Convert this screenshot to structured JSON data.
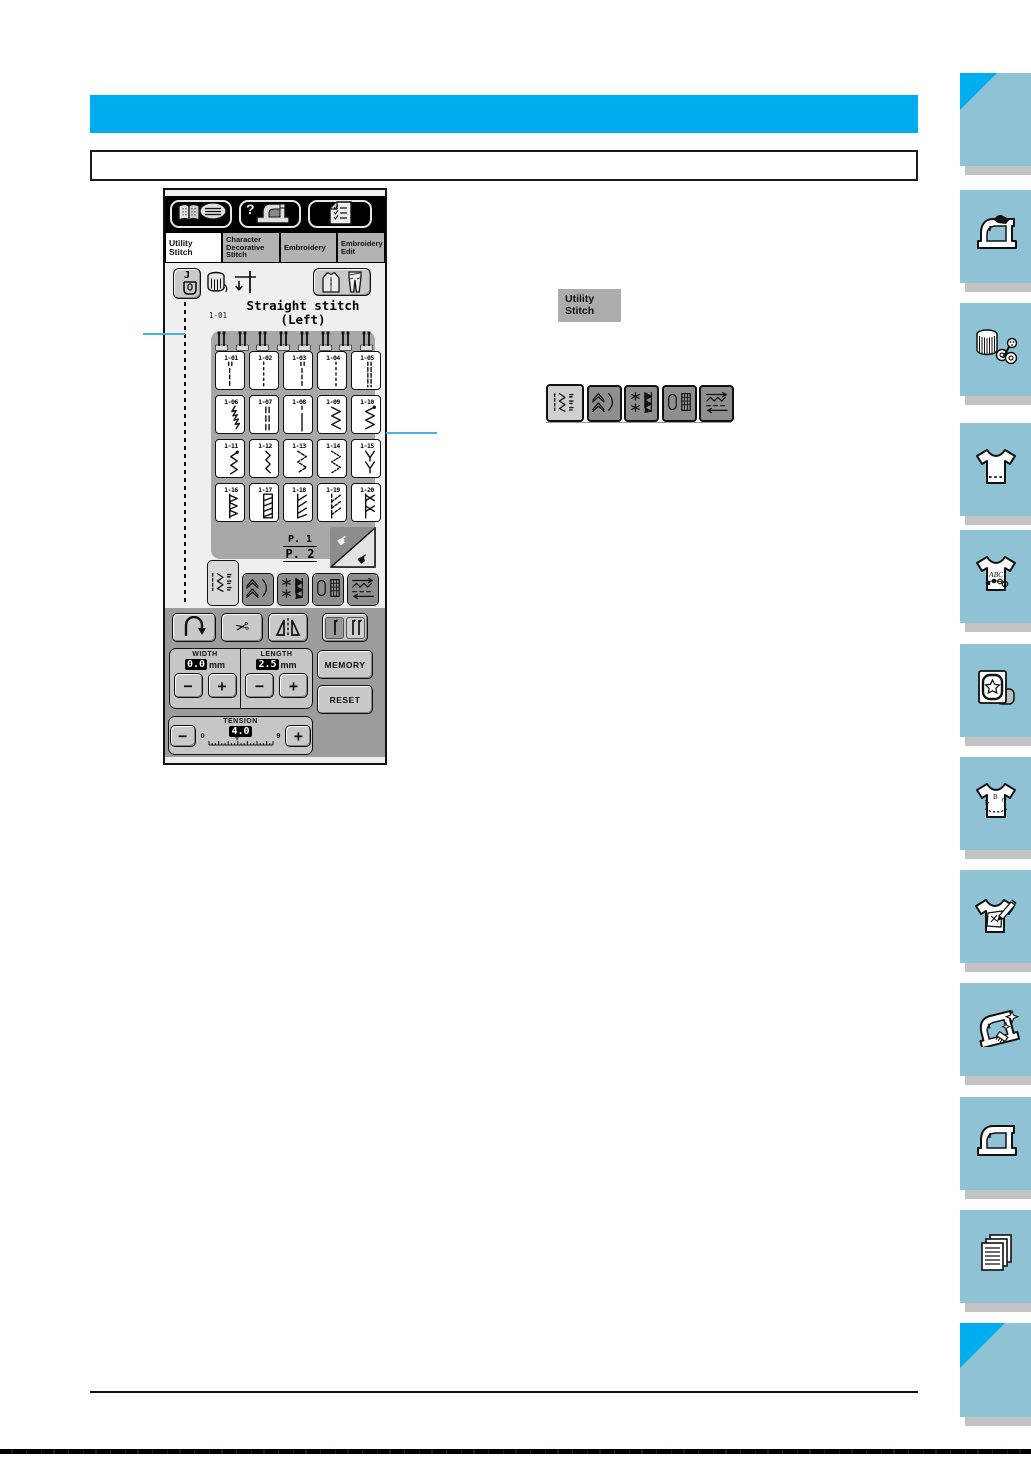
{
  "page": {
    "header_bar_text": "",
    "subheading_box_text": ""
  },
  "colors": {
    "accent_cyan": "#00AEEF",
    "callout_cyan": "#45B2E2",
    "sidebar_blue": "#8FC2D5",
    "sidebar_shadow_grey": "#C3C3C3",
    "lcd_panel_grey": "#A8A8A8",
    "lcd_control_grey": "#9C9C9C"
  },
  "lcd": {
    "top_buttons": [
      {
        "name": "operation-guide-button",
        "icon": "book-guide-icon"
      },
      {
        "name": "troubleshooting-button",
        "icon": "question-machine-icon"
      },
      {
        "name": "settings-button",
        "icon": "checklist-icon"
      }
    ],
    "tabs": [
      {
        "name": "tab-utility-stitch",
        "lines": [
          "Utility",
          "Stitch"
        ],
        "active": true
      },
      {
        "name": "tab-character-decorative-stitch",
        "lines": [
          "Character",
          "Decorative",
          "Stitch"
        ],
        "active": false
      },
      {
        "name": "tab-embroidery",
        "lines": [
          "Embroidery"
        ],
        "active": false
      },
      {
        "name": "tab-embroidery-edit",
        "lines": [
          "Embroidery",
          "Edit"
        ],
        "active": false
      }
    ],
    "status": {
      "foot_label": "J",
      "stitch_code": "1-01",
      "name_line1": "Straight stitch",
      "name_line2": "(Left)"
    },
    "grid": {
      "needle_marker_count": 8,
      "cells": [
        {
          "id": "1-01",
          "pattern": "straight-left"
        },
        {
          "id": "1-02",
          "pattern": "straight-left-single"
        },
        {
          "id": "1-03",
          "pattern": "straight-middle"
        },
        {
          "id": "1-04",
          "pattern": "straight-middle-single"
        },
        {
          "id": "1-05",
          "pattern": "triple-stretch"
        },
        {
          "id": "1-06",
          "pattern": "stem"
        },
        {
          "id": "1-07",
          "pattern": "decorative-dash"
        },
        {
          "id": "1-08",
          "pattern": "basting"
        },
        {
          "id": "1-09",
          "pattern": "zigzag"
        },
        {
          "id": "1-10",
          "pattern": "zigzag-right"
        },
        {
          "id": "1-11",
          "pattern": "zigzag-small"
        },
        {
          "id": "1-12",
          "pattern": "zigzag-narrow"
        },
        {
          "id": "1-13",
          "pattern": "elastic-2step"
        },
        {
          "id": "1-14",
          "pattern": "elastic-3step"
        },
        {
          "id": "1-15",
          "pattern": "overcast-y"
        },
        {
          "id": "1-16",
          "pattern": "overcast-tri"
        },
        {
          "id": "1-17",
          "pattern": "overcast-ladder"
        },
        {
          "id": "1-18",
          "pattern": "overcast-diag"
        },
        {
          "id": "1-19",
          "pattern": "overcast-diag-dash"
        },
        {
          "id": "1-20",
          "pattern": "overcast-cross"
        }
      ]
    },
    "page_indicator": {
      "top": "P. 1",
      "bottom": "P. 2"
    },
    "category_buttons": [
      {
        "name": "category-utility-group",
        "icon": "utility-group-icon",
        "active": true
      },
      {
        "name": "category-scallop-group",
        "icon": "scallop-group-icon",
        "active": false
      },
      {
        "name": "category-satin-group",
        "icon": "satin-group-icon",
        "active": false
      },
      {
        "name": "category-buttonhole-group",
        "icon": "buttonhole-group-icon",
        "active": false
      },
      {
        "name": "category-special-group",
        "icon": "special-group-icon",
        "active": false
      }
    ],
    "controls": {
      "minus": "−",
      "plus": "+",
      "width": {
        "label": "WIDTH",
        "value": "0.0",
        "unit": "mm"
      },
      "length": {
        "label": "LENGTH",
        "value": "2.5",
        "unit": "mm"
      },
      "memory_label": "MEMORY",
      "reset_label": "RESET",
      "tension": {
        "label": "TENSION",
        "min": "0",
        "value": "4.0",
        "max": "9"
      }
    }
  },
  "inline": {
    "utility_button": {
      "line1": "Utility",
      "line2": "Stitch"
    },
    "category_buttons": [
      {
        "name": "inline-category-utility-group",
        "icon": "utility-group-icon",
        "active": true
      },
      {
        "name": "inline-category-scallop-group",
        "icon": "scallop-group-icon",
        "active": false
      },
      {
        "name": "inline-category-satin-group",
        "icon": "satin-group-icon",
        "active": false
      },
      {
        "name": "inline-category-buttonhole-group",
        "icon": "buttonhole-group-icon",
        "active": false
      },
      {
        "name": "inline-category-special-group",
        "icon": "special-group-icon",
        "active": false
      }
    ]
  },
  "sidebar": {
    "items": [
      {
        "name": "page-corner-marker-top",
        "icon": "corner-triangle"
      },
      {
        "name": "chapter-sewing-machine-hand",
        "icon": "sewing-machine-hand-icon"
      },
      {
        "name": "chapter-thread-spool",
        "icon": "thread-spool-icon"
      },
      {
        "name": "chapter-shirt-hem",
        "icon": "shirt-hem-icon"
      },
      {
        "name": "chapter-shirt-abc-flower",
        "icon": "shirt-abc-flower-icon"
      },
      {
        "name": "chapter-embroidery-hoop",
        "icon": "embroidery-hoop-icon"
      },
      {
        "name": "chapter-shirt-abc-arc",
        "icon": "shirt-abc-arc-icon"
      },
      {
        "name": "chapter-shirt-pencil",
        "icon": "shirt-pencil-icon"
      },
      {
        "name": "chapter-machine-maintenance",
        "icon": "machine-maintenance-icon"
      },
      {
        "name": "chapter-sewing-machine",
        "icon": "sewing-machine-icon"
      },
      {
        "name": "chapter-documents",
        "icon": "documents-icon"
      },
      {
        "name": "page-corner-marker-bottom",
        "icon": "corner-triangle"
      }
    ]
  }
}
